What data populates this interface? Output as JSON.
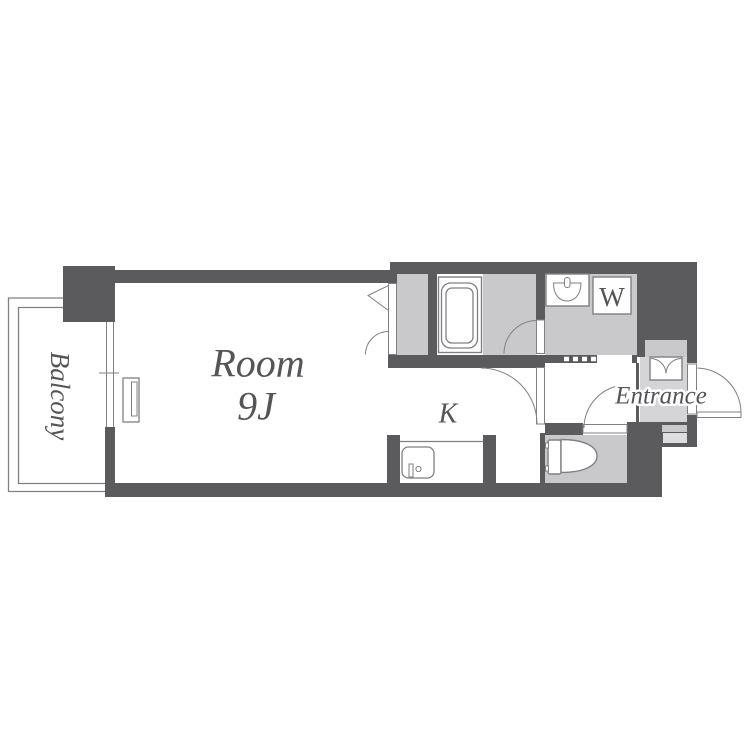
{
  "floorplan": {
    "labels": {
      "room_line1": "Room",
      "room_line2": "9J",
      "kitchen": "K",
      "balcony": "Balcony",
      "entrance": "Entrance",
      "washer": "W"
    },
    "colors": {
      "wall": "#5b5b5d",
      "room_fill": "#c9c9cb",
      "entry_fill": "#d5d5d7",
      "step_fill": "#dedee0",
      "line": "#808083",
      "text": "#555558",
      "background": "#ffffff"
    }
  }
}
